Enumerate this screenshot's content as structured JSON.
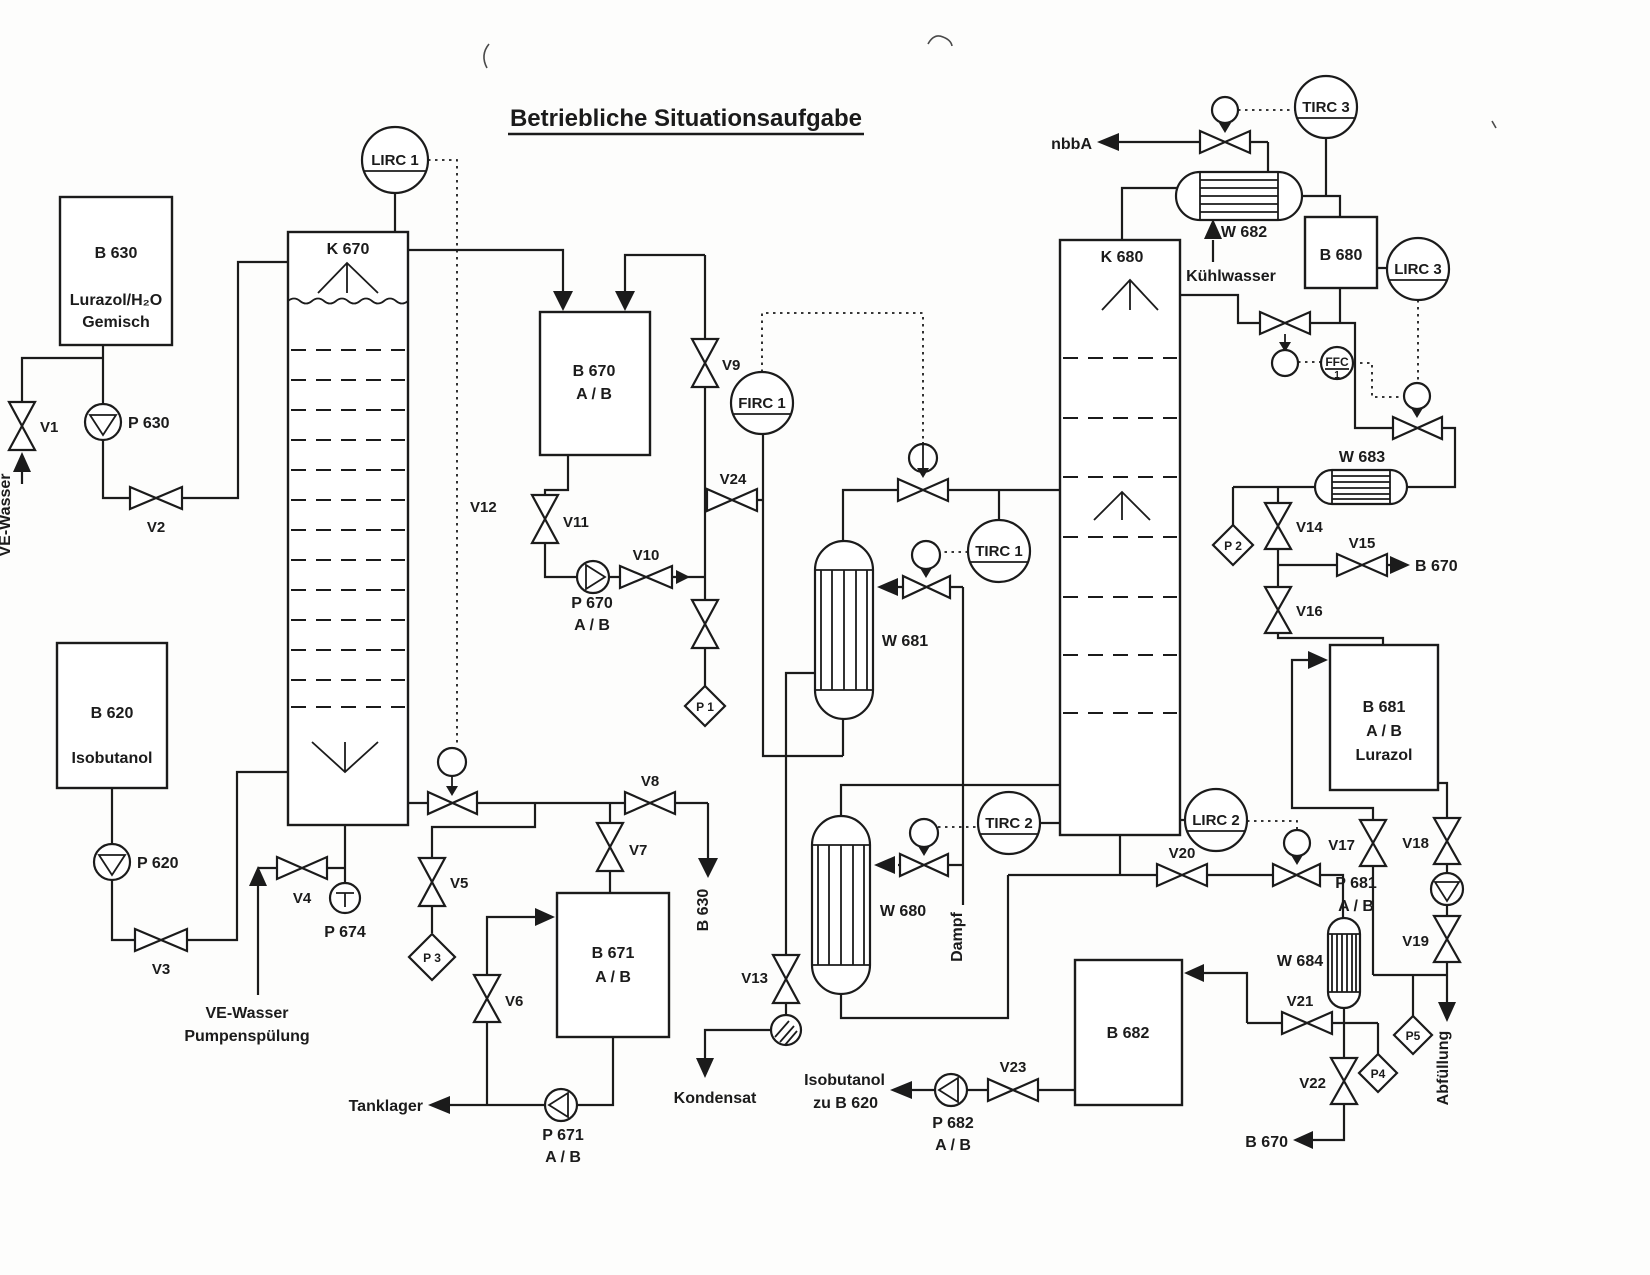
{
  "title": "Betriebliche Situationsaufgabe",
  "columns": {
    "k670": "K 670",
    "k680": "K 680"
  },
  "vessels": {
    "b630": {
      "id": "B 630",
      "line1": "Lurazol/H₂O",
      "line2": "Gemisch"
    },
    "b620": {
      "id": "B 620",
      "line1": "Isobutanol"
    },
    "b670": {
      "id": "B 670",
      "line1": "A / B"
    },
    "b671": {
      "id": "B 671",
      "line1": "A / B"
    },
    "b680": {
      "id": "B 680"
    },
    "b681": {
      "id": "B 681",
      "line1": "A / B",
      "line2": "Lurazol"
    },
    "b682": {
      "id": "B 682"
    }
  },
  "exchangers": {
    "w680": "W 680",
    "w681": "W 681",
    "w682": "W 682",
    "w683": "W 683",
    "w684": "W 684"
  },
  "pumps": {
    "p630": "P 630",
    "p620": "P 620",
    "p674": "P 674",
    "p670": {
      "id": "P 670",
      "ab": "A / B"
    },
    "p671": {
      "id": "P 671",
      "ab": "A / B"
    },
    "p681": {
      "id": "P 681",
      "ab": "A / B"
    },
    "p682": {
      "id": "P 682",
      "ab": "A / B"
    }
  },
  "valves": {
    "v1": "V1",
    "v2": "V2",
    "v3": "V3",
    "v4": "V4",
    "v5": "V5",
    "v6": "V6",
    "v7": "V7",
    "v8": "V8",
    "v9": "V9",
    "v10": "V10",
    "v11": "V11",
    "v12": "V12",
    "v13": "V13",
    "v14": "V14",
    "v15": "V15",
    "v16": "V16",
    "v17": "V17",
    "v18": "V18",
    "v19": "V19",
    "v20": "V20",
    "v21": "V21",
    "v22": "V22",
    "v23": "V23",
    "v24": "V24"
  },
  "instruments": {
    "lirc1": "LIRC 1",
    "firc1": "FIRC 1",
    "tirc1": "TIRC 1",
    "tirc2": "TIRC 2",
    "tirc3": "TIRC 3",
    "lirc2": "LIRC 2",
    "lirc3": "LIRC 3",
    "ffc_line1": "FFC",
    "ffc_line2": "1"
  },
  "sample_points": {
    "p1": "P 1",
    "p2": "P 2",
    "p3": "P 3",
    "p4": "P4",
    "p5": "P5"
  },
  "streams": {
    "ve_wasser": "VE-Wasser",
    "spuelung_line1": "VE-Wasser",
    "spuelung_line2": "Pumpenspülung",
    "nbba": "nbbA",
    "kuehlwasser": "Kühlwasser",
    "dampf": "Dampf",
    "kondensat": "Kondensat",
    "tanklager": "Tanklager",
    "abfuellung": "Abfüllung",
    "iso_line1": "Isobutanol",
    "iso_line2": "zu B 620",
    "to_b630": "B 630",
    "to_b670_top": "B 670",
    "to_b670_bottom": "B 670"
  }
}
